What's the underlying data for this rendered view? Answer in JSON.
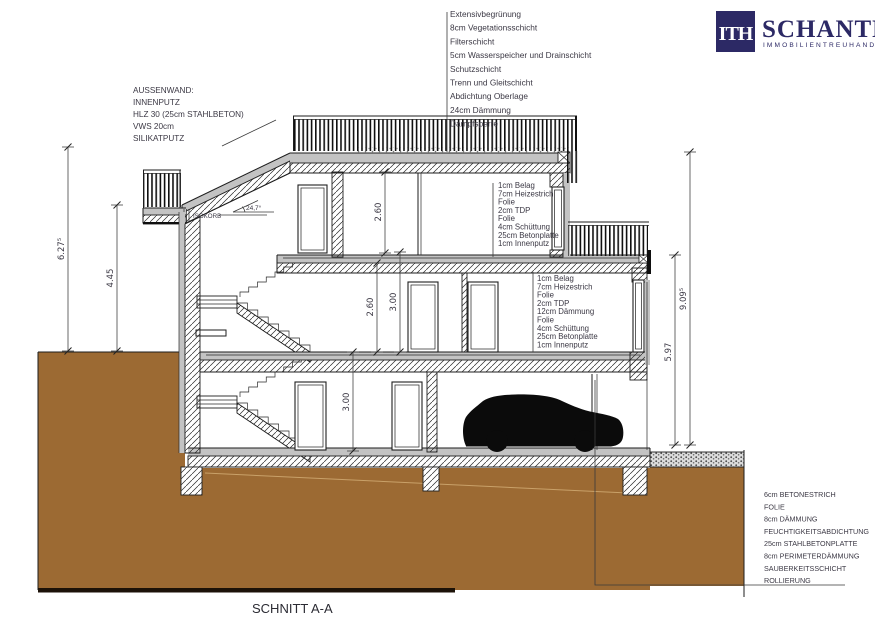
{
  "header": {
    "logo": {
      "mark": "ITH",
      "company": "SCHANTL",
      "tagline": "IMMOBILIENTREUHAND"
    }
  },
  "title": {
    "label": "SCHNITT A-A"
  },
  "roof_buildup": {
    "items": [
      "Extensivbegrünung",
      "8cm Vegetationsschicht",
      "Filterschicht",
      "5cm Wasserspeicher und Drainschicht",
      "Schutzschicht",
      "Trenn und Gleitschicht",
      "Abdichtung Oberlage",
      "24cm Dämmung",
      "Dampfsperre"
    ]
  },
  "wall_buildup": {
    "items": [
      "AUSSENWAND:",
      "INNENPUTZ",
      "HLZ 30 (25cm STAHLBETON)",
      "VWS 20cm",
      "SILIKATPUTZ"
    ]
  },
  "upper_floor_buildup": {
    "items": [
      "1cm Belag",
      "7cm Heizestrich",
      "Folie",
      "2cm TDP",
      "Folie",
      "4cm Schüttung",
      "25cm Betonplatte",
      "1cm Innenputz"
    ]
  },
  "mid_floor_buildup": {
    "items": [
      "1cm Belag",
      "7cm Heizestrich",
      "Folie",
      "2cm TDP",
      "12cm Dämmung",
      "Folie",
      "4cm Schüttung",
      "25cm Betonplatte",
      "1cm Innenputz"
    ]
  },
  "foundation_buildup": {
    "items": [
      "6cm BETONESTRICH",
      "FOLIE",
      "8cm DÄMMUNG",
      "FEUCHTIGKEITSABDICHTUNG",
      "25cm STAHLBETONPLATTE",
      "8cm PERIMETERDÄMMUNG",
      "SAUBERKEITSSCHICHT",
      "ROLLIERUNG"
    ]
  },
  "labels": {
    "isokorb": "ISOKORB",
    "roof_angle": "24,7°"
  },
  "dimensions": {
    "left_total": "6.27⁵",
    "left_upper": "4.45",
    "right_total": "9.09⁵",
    "right_lower": "5.97",
    "top_floor_clear": "2.60",
    "mid_floor_clear": "2.60",
    "mid_storey": "3.00",
    "ground_storey": "3.00"
  },
  "colors": {
    "accent_navy": "#2c2965",
    "ground_brown": "#9c6a33",
    "slab_gray": "#c7c7c7"
  }
}
